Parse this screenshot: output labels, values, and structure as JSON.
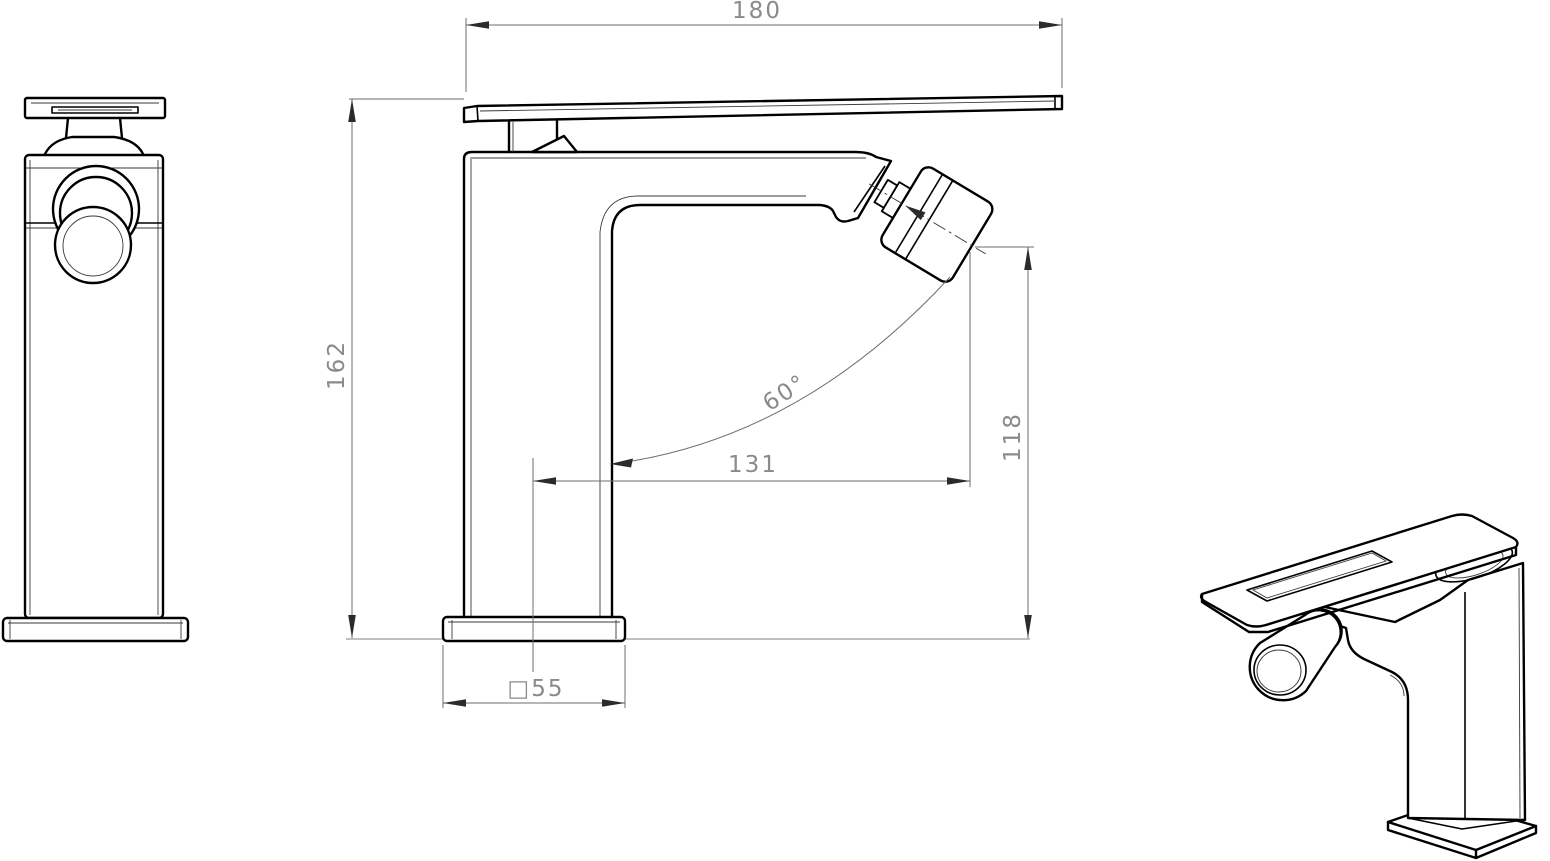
{
  "views": {
    "front": "front-view",
    "side": "side-view",
    "perspective": "perspective-view"
  },
  "dimensions": {
    "handle_length": "180",
    "total_height": "162",
    "spout_reach": "131",
    "spout_height": "118",
    "spray_angle": "60°",
    "base_square": "□55"
  },
  "colors": {
    "line": "#000000",
    "dimension": "#6e6e6e",
    "text": "#8a8a8a",
    "background": "#ffffff"
  }
}
